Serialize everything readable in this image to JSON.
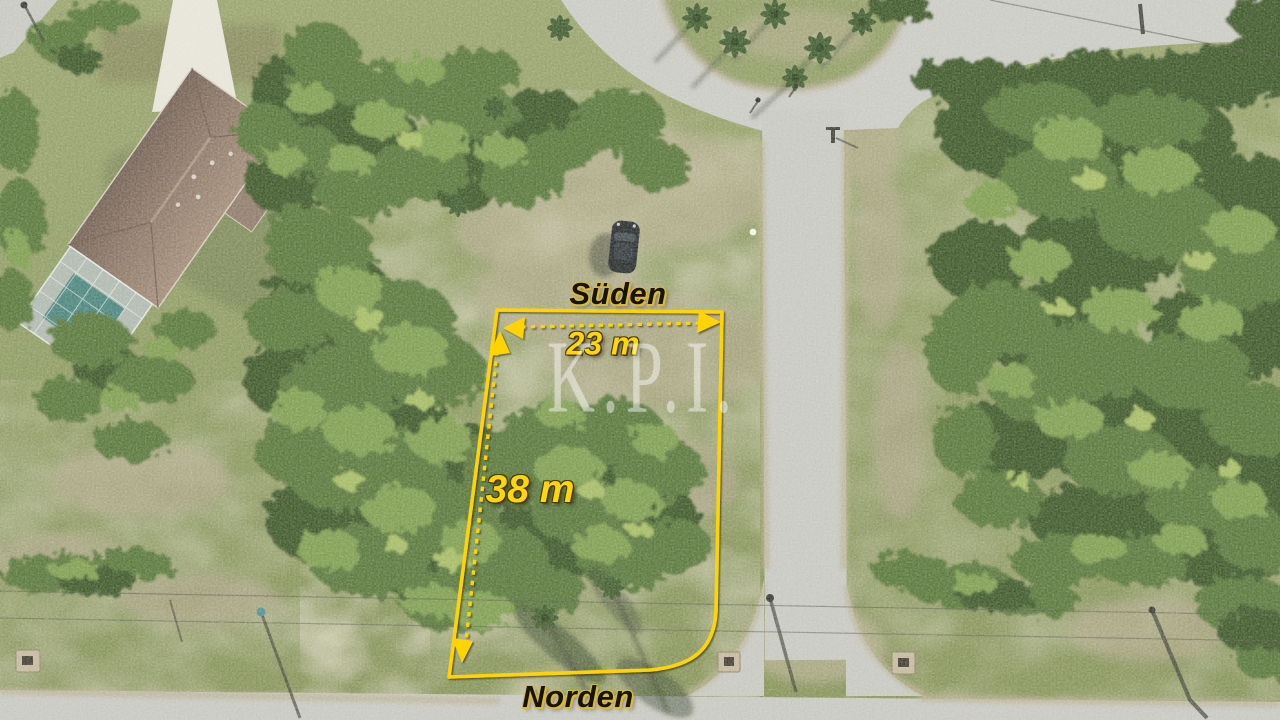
{
  "annotations": {
    "direction_top": "Süden",
    "direction_bottom": "Norden",
    "width_label": "23 m",
    "depth_label": "38 m"
  },
  "watermark": {
    "text": "K.P.I."
  },
  "colors": {
    "boundary": "#FFD400",
    "measure": "#FFD60A",
    "direction": "#15140A",
    "glow": "#D9B83D",
    "watermark": "#FFFFFF"
  }
}
